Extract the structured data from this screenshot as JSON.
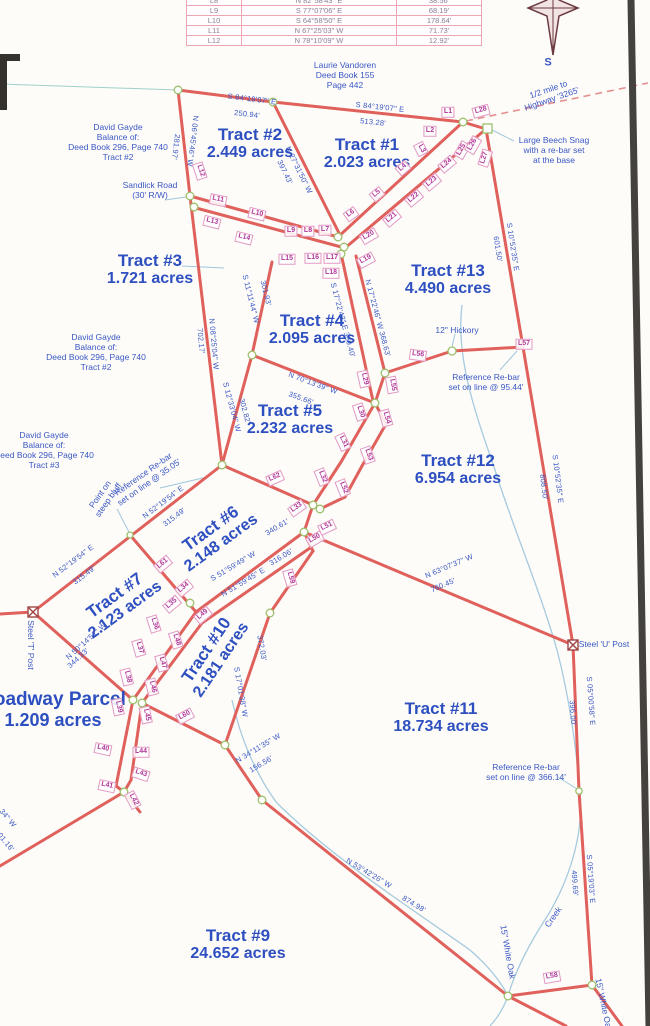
{
  "table": {
    "rows": [
      [
        "L8",
        "N 82°58'43\" E",
        "38.56'"
      ],
      [
        "L9",
        "S 77°07'06\" E",
        "68.19'"
      ],
      [
        "L10",
        "S 64°58'50\" E",
        "178.64'"
      ],
      [
        "L11",
        "N 67°25'03\" W",
        "71.73'"
      ],
      [
        "L12",
        "N 78°10'09\" W",
        "12.92'"
      ]
    ]
  },
  "tracts": [
    {
      "name": "Tract #2",
      "acres": "2.449 acres",
      "x": 250,
      "y": 144,
      "r": 0
    },
    {
      "name": "Tract #1",
      "acres": "2.023 acres",
      "x": 367,
      "y": 154,
      "r": 0
    },
    {
      "name": "Tract #3",
      "acres": "1.721 acres",
      "x": 150,
      "y": 270,
      "r": 0
    },
    {
      "name": "Tract #4",
      "acres": "2.095 acres",
      "x": 312,
      "y": 330,
      "r": 0
    },
    {
      "name": "Tract #5",
      "acres": "2.232 acres",
      "x": 290,
      "y": 420,
      "r": 0
    },
    {
      "name": "Tract #6",
      "acres": "2.148 acres",
      "x": 216,
      "y": 536,
      "r": -36
    },
    {
      "name": "Tract #7",
      "acres": "2.123 acres",
      "x": 120,
      "y": 603,
      "r": -36
    },
    {
      "name": "Tract #10",
      "acres": "2.181 acres",
      "x": 214,
      "y": 655,
      "r": -56
    },
    {
      "name": "Tract #11",
      "acres": "18.734 acres",
      "x": 441,
      "y": 718,
      "r": 0
    },
    {
      "name": "Tract #12",
      "acres": "6.954 acres",
      "x": 458,
      "y": 470,
      "r": 0
    },
    {
      "name": "Tract #13",
      "acres": "4.490 acres",
      "x": 448,
      "y": 280,
      "r": 0
    },
    {
      "name": "Tract #9",
      "acres": "24.652 acres",
      "x": 238,
      "y": 945,
      "r": 0
    },
    {
      "name": "Roadway Parcel",
      "acres": "1.209 acres",
      "x": 53,
      "y": 710,
      "r": 0,
      "big": true
    }
  ],
  "bearings": [
    {
      "t": "S 84°19'07\" E",
      "x": 252,
      "y": 99,
      "r": 7
    },
    {
      "t": "250.94'",
      "x": 247,
      "y": 114,
      "r": 7
    },
    {
      "t": "S 84°19'07\" E",
      "x": 380,
      "y": 107,
      "r": 6
    },
    {
      "t": "513.28'",
      "x": 373,
      "y": 122,
      "r": 6
    },
    {
      "t": "N 06°45'46\" W",
      "x": 193,
      "y": 141,
      "r": 97
    },
    {
      "t": "281.97'",
      "x": 176,
      "y": 147,
      "r": 97
    },
    {
      "t": "N 27°31'50\" W",
      "x": 299,
      "y": 170,
      "r": 64
    },
    {
      "t": "397.43'",
      "x": 285,
      "y": 172,
      "r": 64
    },
    {
      "t": "S 10°52'35\" E",
      "x": 513,
      "y": 247,
      "r": 81
    },
    {
      "t": "601.50'",
      "x": 498,
      "y": 249,
      "r": 81
    },
    {
      "t": "S 11°11'44\" W",
      "x": 251,
      "y": 299,
      "r": 76
    },
    {
      "t": "301.93'",
      "x": 266,
      "y": 293,
      "r": 76
    },
    {
      "t": "N 08°25'04\" W",
      "x": 214,
      "y": 344,
      "r": 85
    },
    {
      "t": "702.17'",
      "x": 201,
      "y": 341,
      "r": 85
    },
    {
      "t": "S 17°22'43\" E 359.40'",
      "x": 343,
      "y": 320,
      "r": 75
    },
    {
      "t": "N 17°22'46\" W 368.63'",
      "x": 378,
      "y": 318,
      "r": 75
    },
    {
      "t": "N 70°13'39\" W",
      "x": 313,
      "y": 383,
      "r": 20
    },
    {
      "t": "355.66'",
      "x": 301,
      "y": 398,
      "r": 20
    },
    {
      "t": "S 12°33'04\" W",
      "x": 232,
      "y": 407,
      "r": 75
    },
    {
      "t": "302.82'",
      "x": 245,
      "y": 411,
      "r": 75
    },
    {
      "t": "S 10°52'35\" E",
      "x": 558,
      "y": 479,
      "r": 83
    },
    {
      "t": "808.50'",
      "x": 544,
      "y": 487,
      "r": 83
    },
    {
      "t": "N 52°19'54\" E",
      "x": 163,
      "y": 502,
      "r": -37
    },
    {
      "t": "315.49'",
      "x": 174,
      "y": 517,
      "r": -37
    },
    {
      "t": "N 52°19'54\" E",
      "x": 73,
      "y": 561,
      "r": -37
    },
    {
      "t": "315.49'",
      "x": 84,
      "y": 575,
      "r": -37
    },
    {
      "t": "S 51°59'49\" W",
      "x": 233,
      "y": 566,
      "r": -31
    },
    {
      "t": "340.61'",
      "x": 277,
      "y": 527,
      "r": -31
    },
    {
      "t": "N 51°59'45\" E",
      "x": 243,
      "y": 582,
      "r": -31
    },
    {
      "t": "316.06'",
      "x": 281,
      "y": 557,
      "r": -31
    },
    {
      "t": "N 50°14'51\" W",
      "x": 86,
      "y": 641,
      "r": -42
    },
    {
      "t": "344.33'",
      "x": 78,
      "y": 658,
      "r": -42
    },
    {
      "t": "N 63°07'37\" W",
      "x": 449,
      "y": 566,
      "r": -23
    },
    {
      "t": "760.45'",
      "x": 443,
      "y": 585,
      "r": -23
    },
    {
      "t": "S 05°00'58\" E",
      "x": 591,
      "y": 701,
      "r": 86
    },
    {
      "t": "396.00'",
      "x": 573,
      "y": 713,
      "r": 86
    },
    {
      "t": "S 17°01'38\" W",
      "x": 241,
      "y": 692,
      "r": 80
    },
    {
      "t": "372.03'",
      "x": 262,
      "y": 648,
      "r": 80
    },
    {
      "t": "N 34°11'35\" W",
      "x": 258,
      "y": 748,
      "r": -31
    },
    {
      "t": "156.56'",
      "x": 261,
      "y": 764,
      "r": -31
    },
    {
      "t": "N 53°42'26\" W",
      "x": 369,
      "y": 873,
      "r": 31
    },
    {
      "t": "874.98'",
      "x": 414,
      "y": 904,
      "r": 31
    },
    {
      "t": "S 05°19'03\" E",
      "x": 591,
      "y": 879,
      "r": 86
    },
    {
      "t": "499.69'",
      "x": 575,
      "y": 883,
      "r": 86
    },
    {
      "t": "34\" W",
      "x": 8,
      "y": 818,
      "r": 50
    },
    {
      "t": "01.16'",
      "x": 6,
      "y": 842,
      "r": 50
    }
  ],
  "notes": [
    {
      "lines": [
        "Laurie Vandoren",
        "Deed Book 155",
        "Page 442"
      ],
      "x": 345,
      "y": 75,
      "r": 0
    },
    {
      "lines": [
        "David Gayde",
        "Balance of:",
        "Deed Book 296, Page 740",
        "Tract #2"
      ],
      "x": 118,
      "y": 142,
      "r": 0
    },
    {
      "lines": [
        "Sandlick Road",
        "(30' R/W)"
      ],
      "x": 150,
      "y": 190,
      "r": 0
    },
    {
      "lines": [
        "David Gayde",
        "Balance of:",
        "Deed Book 296, Page 740",
        "Tract #2"
      ],
      "x": 96,
      "y": 352,
      "r": 0
    },
    {
      "lines": [
        "David Gayde",
        "Balance of:",
        "Deed Book 296, Page 740",
        "Tract #3"
      ],
      "x": 44,
      "y": 450,
      "r": 0
    },
    {
      "lines": [
        "Reference Re-bar",
        "set on line @ 35.05'"
      ],
      "x": 146,
      "y": 478,
      "r": -35
    },
    {
      "lines": [
        "Point on",
        "steep bluff"
      ],
      "x": 104,
      "y": 497,
      "r": -55
    },
    {
      "lines": [
        "1/2 mile to",
        "Highway '3265'"
      ],
      "x": 550,
      "y": 94,
      "r": -19
    },
    {
      "lines": [
        "Large Beech Snag",
        "with a re-bar set",
        "at the base"
      ],
      "x": 554,
      "y": 150,
      "r": 0
    },
    {
      "lines": [
        "12\" Hickory"
      ],
      "x": 457,
      "y": 330,
      "r": 0
    },
    {
      "lines": [
        "Reference Re-bar",
        "set on line @ 95.44'"
      ],
      "x": 486,
      "y": 382,
      "r": 0
    },
    {
      "lines": [
        "Steel 'T' Post"
      ],
      "x": 31,
      "y": 645,
      "r": 90
    },
    {
      "lines": [
        "Steel 'U' Post"
      ],
      "x": 604,
      "y": 644,
      "r": 0
    },
    {
      "lines": [
        "Reference Re-bar",
        "set on line @ 366.14'"
      ],
      "x": 526,
      "y": 772,
      "r": 0
    },
    {
      "lines": [
        "15\" White Oak"
      ],
      "x": 508,
      "y": 952,
      "r": 80
    },
    {
      "lines": [
        "Creek"
      ],
      "x": 553,
      "y": 917,
      "r": -55
    },
    {
      "lines": [
        "15\" White Oak"
      ],
      "x": 604,
      "y": 1005,
      "r": 78
    },
    {
      "lines": [
        "S"
      ],
      "x": 548,
      "y": 63,
      "r": 0,
      "size": "big"
    }
  ],
  "line_labels": [
    {
      "t": "L1",
      "x": 448,
      "y": 112,
      "r": 0
    },
    {
      "t": "L2",
      "x": 430,
      "y": 131,
      "r": 0
    },
    {
      "t": "L3",
      "x": 421,
      "y": 149,
      "r": 62
    },
    {
      "t": "L4",
      "x": 403,
      "y": 168,
      "r": -40
    },
    {
      "t": "L5",
      "x": 377,
      "y": 194,
      "r": -40
    },
    {
      "t": "L6",
      "x": 351,
      "y": 214,
      "r": -35
    },
    {
      "t": "L7",
      "x": 325,
      "y": 230,
      "r": 0
    },
    {
      "t": "L8",
      "x": 308,
      "y": 231,
      "r": 0
    },
    {
      "t": "L9",
      "x": 291,
      "y": 231,
      "r": 0
    },
    {
      "t": "L10",
      "x": 257,
      "y": 214,
      "r": 14
    },
    {
      "t": "L11",
      "x": 218,
      "y": 200,
      "r": 12
    },
    {
      "t": "L12",
      "x": 200,
      "y": 171,
      "r": 72
    },
    {
      "t": "L13",
      "x": 212,
      "y": 222,
      "r": 14
    },
    {
      "t": "L14",
      "x": 244,
      "y": 238,
      "r": 14
    },
    {
      "t": "L15",
      "x": 287,
      "y": 259,
      "r": 0
    },
    {
      "t": "L16",
      "x": 313,
      "y": 258,
      "r": 0
    },
    {
      "t": "L17",
      "x": 332,
      "y": 258,
      "r": 0
    },
    {
      "t": "L18",
      "x": 331,
      "y": 273,
      "r": 0
    },
    {
      "t": "L19",
      "x": 366,
      "y": 260,
      "r": -28
    },
    {
      "t": "L20",
      "x": 369,
      "y": 236,
      "r": -30
    },
    {
      "t": "L21",
      "x": 392,
      "y": 218,
      "r": -40
    },
    {
      "t": "L22",
      "x": 414,
      "y": 198,
      "r": -40
    },
    {
      "t": "L23",
      "x": 432,
      "y": 182,
      "r": -40
    },
    {
      "t": "L24",
      "x": 447,
      "y": 164,
      "r": -40
    },
    {
      "t": "L25",
      "x": 462,
      "y": 150,
      "r": -60
    },
    {
      "t": "L26",
      "x": 473,
      "y": 145,
      "r": -60
    },
    {
      "t": "L27",
      "x": 485,
      "y": 158,
      "r": -72
    },
    {
      "t": "L28",
      "x": 481,
      "y": 111,
      "r": -15
    },
    {
      "t": "L29",
      "x": 364,
      "y": 379,
      "r": 78
    },
    {
      "t": "L30",
      "x": 360,
      "y": 412,
      "r": 72
    },
    {
      "t": "L31",
      "x": 343,
      "y": 442,
      "r": 65
    },
    {
      "t": "L32",
      "x": 322,
      "y": 477,
      "r": 68
    },
    {
      "t": "L33",
      "x": 297,
      "y": 508,
      "r": -35
    },
    {
      "t": "L34",
      "x": 184,
      "y": 588,
      "r": -40
    },
    {
      "t": "L35",
      "x": 172,
      "y": 604,
      "r": -40
    },
    {
      "t": "L36",
      "x": 154,
      "y": 624,
      "r": 72
    },
    {
      "t": "L37",
      "x": 139,
      "y": 648,
      "r": 74
    },
    {
      "t": "L38",
      "x": 127,
      "y": 677,
      "r": 76
    },
    {
      "t": "L39",
      "x": 118,
      "y": 707,
      "r": 78
    },
    {
      "t": "L40",
      "x": 103,
      "y": 749,
      "r": 12
    },
    {
      "t": "L41",
      "x": 107,
      "y": 786,
      "r": 12
    },
    {
      "t": "L42",
      "x": 133,
      "y": 800,
      "r": 62
    },
    {
      "t": "L43",
      "x": 141,
      "y": 774,
      "r": 18
    },
    {
      "t": "L44",
      "x": 141,
      "y": 752,
      "r": 0
    },
    {
      "t": "L45",
      "x": 146,
      "y": 715,
      "r": 78
    },
    {
      "t": "L46",
      "x": 152,
      "y": 687,
      "r": 76
    },
    {
      "t": "L47",
      "x": 162,
      "y": 663,
      "r": 74
    },
    {
      "t": "L48",
      "x": 176,
      "y": 640,
      "r": 72
    },
    {
      "t": "L49",
      "x": 203,
      "y": 615,
      "r": -40
    },
    {
      "t": "L50",
      "x": 315,
      "y": 539,
      "r": -30
    },
    {
      "t": "L51",
      "x": 327,
      "y": 527,
      "r": -25
    },
    {
      "t": "L52",
      "x": 343,
      "y": 488,
      "r": 68
    },
    {
      "t": "L53",
      "x": 368,
      "y": 455,
      "r": 70
    },
    {
      "t": "L54",
      "x": 386,
      "y": 418,
      "r": 74
    },
    {
      "t": "L55",
      "x": 392,
      "y": 385,
      "r": 80
    },
    {
      "t": "L56",
      "x": 418,
      "y": 355,
      "r": 8
    },
    {
      "t": "L57",
      "x": 524,
      "y": 344,
      "r": 0
    },
    {
      "t": "L58",
      "x": 552,
      "y": 977,
      "r": -10
    },
    {
      "t": "L59",
      "x": 290,
      "y": 578,
      "r": 74
    },
    {
      "t": "L60",
      "x": 185,
      "y": 716,
      "r": -28
    },
    {
      "t": "L61",
      "x": 163,
      "y": 564,
      "r": -40
    },
    {
      "t": "L62",
      "x": 275,
      "y": 478,
      "r": -24
    }
  ],
  "colors": {
    "survey_line": "#e0605c",
    "label_magenta": "#b03899",
    "annotation_blue": "#3a57c4",
    "tract_blue": "#2d4fc0",
    "creek_blue": "#a6cade",
    "table_grid_pink": "#eaa6b2",
    "scan_border_dark": "#45413d"
  }
}
